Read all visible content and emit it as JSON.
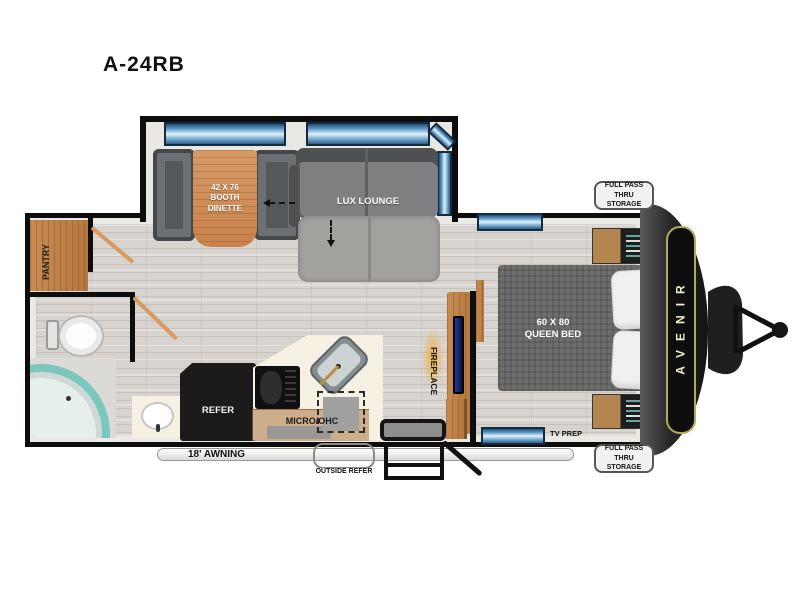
{
  "title": "A-24RB",
  "floorplan": {
    "slideout": {
      "dinette_label": "42 X 76\nBOOTH\nDINETTE",
      "lounge_label": "LUX LOUNGE"
    },
    "pantry_label": "PANTRY",
    "bed_label": "60 X 80\nQUEEN BED",
    "fireplace_label": "FIREPLACE",
    "refer_label": "REFER",
    "micro_label": "MICRO/OHC",
    "tv_prep_label": "TV PREP",
    "awning_label": "18' AWNING",
    "outside_refer_label": "OUTSIDE REFER",
    "storage_top_label": "FULL PASS THRU\nSTORAGE",
    "storage_bottom_label": "FULL PASS THRU\nSTORAGE",
    "brand": "AVENIR"
  },
  "colors": {
    "wall": "#0d0d0d",
    "window_blue": "#5e9cc8",
    "wood": "#cf8f5c",
    "sofa_gray": "#8a8a8a",
    "shower_teal": "#7cc7bd",
    "counter_cream": "#f6f1e2",
    "brand_gold": "#b3a960"
  }
}
